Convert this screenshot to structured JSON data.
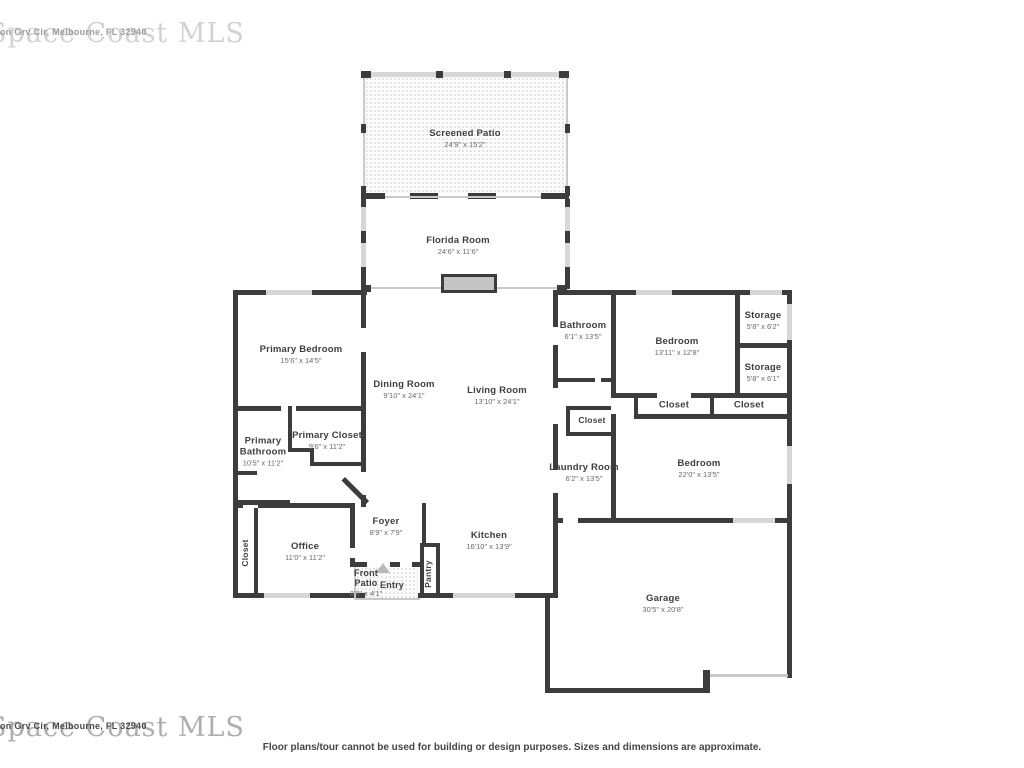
{
  "watermark": {
    "brand": "Space Coast MLS",
    "address": "on Grv Cir, Melbourne, FL 32940"
  },
  "disclaimer": "Floor plans/tour cannot be used for building or design purposes. Sizes and dimensions are approximate.",
  "colors": {
    "wall": "#3c3c3c",
    "window": "#d6d6d6",
    "hatch_dot": "#dedede",
    "label": "#3f3f3f",
    "dims": "#6a6a6a"
  },
  "rooms": {
    "screened_patio": {
      "name": "Screened Patio",
      "dims": "24'9\" x 15'2\""
    },
    "florida_room": {
      "name": "Florida Room",
      "dims": "24'6\" x 11'6\""
    },
    "primary_bedroom": {
      "name": "Primary Bedroom",
      "dims": "15'6\" x 14'5\""
    },
    "dining_room": {
      "name": "Dining Room",
      "dims": "9'10\" x 24'1\""
    },
    "living_room": {
      "name": "Living Room",
      "dims": "13'10\" x 24'1\""
    },
    "bathroom": {
      "name": "Bathroom",
      "dims": "6'1\" x 13'5\""
    },
    "bedroom_top": {
      "name": "Bedroom",
      "dims": "13'11\" x 12'8\""
    },
    "storage_1": {
      "name": "Storage",
      "dims": "5'8\" x 6'2\""
    },
    "storage_2": {
      "name": "Storage",
      "dims": "5'8\" x 6'1\""
    },
    "closet_a": {
      "name": "Closet"
    },
    "closet_b": {
      "name": "Closet"
    },
    "closet_hall": {
      "name": "Closet"
    },
    "primary_bathroom": {
      "name": "Primary Bathroom",
      "dims": "10'5\" x 11'2\""
    },
    "primary_closet": {
      "name": "Primary Closet",
      "dims": "9'6\" x 11'2\""
    },
    "laundry_room": {
      "name": "Laundry Room",
      "dims": "6'2\" x 13'5\""
    },
    "bedroom_bottom": {
      "name": "Bedroom",
      "dims": "22'0\" x 13'5\""
    },
    "closet_office": {
      "name": "Closet"
    },
    "office": {
      "name": "Office",
      "dims": "11'0\" x 11'2\""
    },
    "foyer": {
      "name": "Foyer",
      "dims": "8'9\" x 7'9\""
    },
    "kitchen": {
      "name": "Kitchen",
      "dims": "16'10\" x 13'9\""
    },
    "pantry": {
      "name": "Pantry"
    },
    "front_patio": {
      "name": "Front Patio",
      "dims": "8'8\" x 4'1\""
    },
    "entry": {
      "name": "Entry"
    },
    "garage": {
      "name": "Garage",
      "dims": "30'5\" x 20'8\""
    }
  }
}
